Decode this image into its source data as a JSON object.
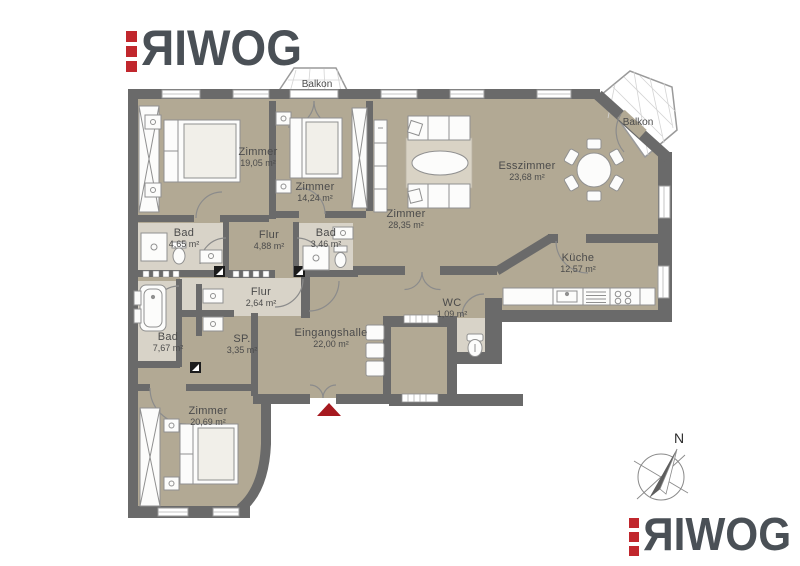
{
  "brand": {
    "mark_letter": "R",
    "rest_letters": "IWOG"
  },
  "colors": {
    "accent_red": "#c1272d",
    "wall_gray": "#6a6a6a",
    "floor_beige": "#b2a994",
    "floor_light": "#d8d3c8",
    "logo_text": "#4a5056",
    "entry_arrow_red": "#a6191f"
  },
  "compass": {
    "north_label": "N"
  },
  "balconies": [
    {
      "label": "Balkon"
    },
    {
      "label": "Balkon"
    }
  ],
  "rooms": [
    {
      "id": "zimmer-1",
      "name": "Zimmer",
      "area": "19,05 m²"
    },
    {
      "id": "zimmer-2",
      "name": "Zimmer",
      "area": "14,24 m²"
    },
    {
      "id": "zimmer-3",
      "name": "Zimmer",
      "area": "28,35 m²"
    },
    {
      "id": "esszimmer",
      "name": "Esszimmer",
      "area": "23,68 m²"
    },
    {
      "id": "kueche",
      "name": "Küche",
      "area": "12,57 m²"
    },
    {
      "id": "bad-1",
      "name": "Bad",
      "area": "4,65 m²"
    },
    {
      "id": "flur-1",
      "name": "Flur",
      "area": "4,88 m²"
    },
    {
      "id": "bad-2",
      "name": "Bad",
      "area": "3,46 m²"
    },
    {
      "id": "flur-2",
      "name": "Flur",
      "area": "2,64 m²"
    },
    {
      "id": "wc",
      "name": "WC",
      "area": "1,09 m²"
    },
    {
      "id": "bad-3",
      "name": "Bad",
      "area": "7,67 m²"
    },
    {
      "id": "sp",
      "name": "SP.",
      "area": "3,35 m²"
    },
    {
      "id": "eingangshalle",
      "name": "Eingangshalle",
      "area": "22,00 m²"
    },
    {
      "id": "zimmer-4",
      "name": "Zimmer",
      "area": "20,69 m²"
    }
  ]
}
